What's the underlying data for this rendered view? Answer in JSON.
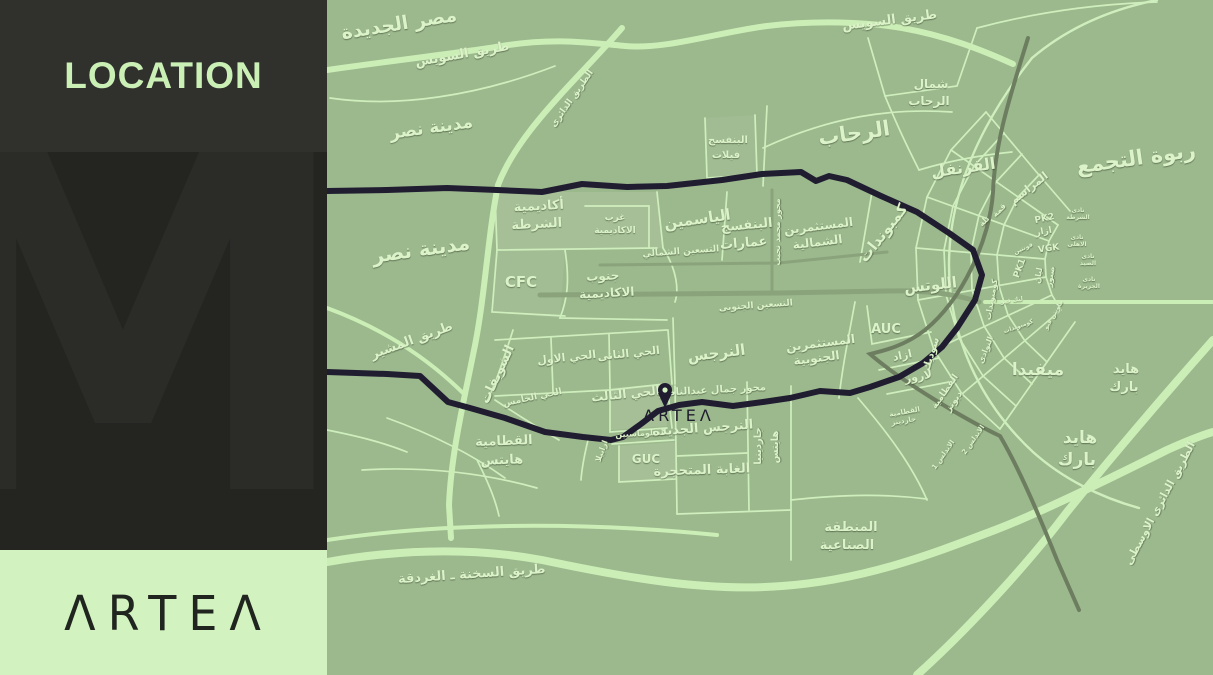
{
  "sidebar": {
    "title": "LOCATION",
    "watermark": "M",
    "logo_display": "ΛRTEΛ",
    "logo_brand": "ARTEA"
  },
  "colors": {
    "panel_dark": "#30302d",
    "panel_darker": "#242421",
    "accent_green": "#cbf0b6",
    "logo_panel_green": "#d2f2bf",
    "map_base": "#9cb88d",
    "road_light": "#cbeeb6",
    "road_gray": "#8aa37b",
    "road_olive": "#6d7e60",
    "route_navy": "#201d31",
    "label_light": "#dcf3c9"
  },
  "map": {
    "marker": {
      "brand": "ARTEA",
      "display": "ΛRTEΛ"
    },
    "labels": [
      {
        "t": "مصر الجديدة",
        "x": 73,
        "y": 30,
        "s": 19,
        "r": -9
      },
      {
        "t": "طريق السويس",
        "x": 136,
        "y": 58,
        "s": 13,
        "r": -10
      },
      {
        "t": "مدينة نصر",
        "x": 105,
        "y": 133,
        "s": 17,
        "r": -8
      },
      {
        "t": "مدينة نصر",
        "x": 95,
        "y": 256,
        "s": 20,
        "r": -8
      },
      {
        "t": "طريق المشير",
        "x": 86,
        "y": 344,
        "s": 13,
        "r": -20
      },
      {
        "t": "الطريق الدائرى",
        "x": 247,
        "y": 100,
        "s": 9,
        "r": -55
      },
      {
        "t": "طريق السويس",
        "x": 563,
        "y": 24,
        "s": 13,
        "r": -7
      },
      {
        "t": "شمال",
        "x": 604,
        "y": 88,
        "s": 12
      },
      {
        "t": "الرحاب",
        "x": 602,
        "y": 105,
        "s": 12
      },
      {
        "t": "الرحاب",
        "x": 528,
        "y": 140,
        "s": 21,
        "r": -8
      },
      {
        "t": "القرنفل",
        "x": 637,
        "y": 173,
        "s": 16,
        "r": -8
      },
      {
        "t": "ربوة التجمع",
        "x": 810,
        "y": 165,
        "s": 21,
        "r": -8
      },
      {
        "t": "البنفسج",
        "x": 401,
        "y": 143,
        "s": 10
      },
      {
        "t": "فيلات",
        "x": 399,
        "y": 158,
        "s": 10
      },
      {
        "t": "أكاديمية",
        "x": 212,
        "y": 210,
        "s": 13,
        "r": -3
      },
      {
        "t": "الشرطة",
        "x": 210,
        "y": 228,
        "s": 13,
        "r": -3
      },
      {
        "t": "غرب",
        "x": 288,
        "y": 220,
        "s": 9
      },
      {
        "t": "الاكاديمية",
        "x": 288,
        "y": 233,
        "s": 9
      },
      {
        "t": "الياسمين",
        "x": 371,
        "y": 224,
        "s": 15,
        "r": -8
      },
      {
        "t": "البنفسج",
        "x": 420,
        "y": 229,
        "s": 13,
        "r": -5
      },
      {
        "t": "عمارات",
        "x": 417,
        "y": 247,
        "s": 13,
        "r": -5
      },
      {
        "t": "المستثمرين",
        "x": 492,
        "y": 230,
        "s": 12,
        "r": -7
      },
      {
        "t": "الشمالية",
        "x": 491,
        "y": 246,
        "s": 12,
        "r": -7
      },
      {
        "t": "كمبوندات",
        "x": 560,
        "y": 236,
        "s": 15,
        "r": -52
      },
      {
        "t": "التسعين الشمالي",
        "x": 354,
        "y": 254,
        "s": 9,
        "r": -4
      },
      {
        "t": "محور محمد نجيب",
        "x": 453,
        "y": 232,
        "s": 8,
        "r": -90
      },
      {
        "t": "جنوب",
        "x": 276,
        "y": 280,
        "s": 12,
        "r": -3
      },
      {
        "t": "الاكاديمية",
        "x": 280,
        "y": 297,
        "s": 12,
        "r": -3
      },
      {
        "t": "CFC",
        "x": 194,
        "y": 287,
        "s": 15,
        "c": "lat"
      },
      {
        "t": "التسعين الجنوبى",
        "x": 429,
        "y": 308,
        "s": 9,
        "r": -4
      },
      {
        "t": "اللوتس",
        "x": 604,
        "y": 290,
        "s": 15,
        "r": -6
      },
      {
        "t": "المستثمرين",
        "x": 494,
        "y": 347,
        "s": 12,
        "r": -7
      },
      {
        "t": "الجنوبية",
        "x": 490,
        "y": 362,
        "s": 12,
        "r": -7
      },
      {
        "t": "AUC",
        "x": 559,
        "y": 333,
        "s": 13,
        "c": "lat"
      },
      {
        "t": "ازاد",
        "x": 576,
        "y": 359,
        "s": 11,
        "r": -12
      },
      {
        "t": "سوديك",
        "x": 607,
        "y": 355,
        "s": 10,
        "r": -72
      },
      {
        "t": "لاروز",
        "x": 592,
        "y": 380,
        "s": 11,
        "r": -10
      },
      {
        "t": "النوادى",
        "x": 661,
        "y": 351,
        "s": 8,
        "r": -68
      },
      {
        "t": "النرجس",
        "x": 390,
        "y": 358,
        "s": 15,
        "r": -7
      },
      {
        "t": "الحي الاول",
        "x": 240,
        "y": 361,
        "s": 11,
        "r": -6
      },
      {
        "t": "الحي الثانى",
        "x": 302,
        "y": 357,
        "s": 11,
        "r": -6
      },
      {
        "t": "الحي الثالث",
        "x": 299,
        "y": 398,
        "s": 12,
        "r": -6
      },
      {
        "t": "الحي الخامس",
        "x": 206,
        "y": 400,
        "s": 9,
        "r": -12
      },
      {
        "t": "الشويفات",
        "x": 174,
        "y": 376,
        "s": 13,
        "r": -65
      },
      {
        "t": "محور جمال عبدالناصر",
        "x": 386,
        "y": 393,
        "s": 10,
        "r": -3
      },
      {
        "t": "الدبلوماسيين",
        "x": 314,
        "y": 436,
        "s": 8,
        "r": -3
      },
      {
        "t": "ارابيلا",
        "x": 277,
        "y": 452,
        "s": 8,
        "r": -70
      },
      {
        "t": "GUC",
        "x": 319,
        "y": 463,
        "s": 12,
        "c": "lat"
      },
      {
        "t": "النرجس الجديدة",
        "x": 376,
        "y": 432,
        "s": 13,
        "r": -4
      },
      {
        "t": "الغابة المتحجرة",
        "x": 375,
        "y": 474,
        "s": 13,
        "r": -2
      },
      {
        "t": "جاردينيا",
        "x": 434,
        "y": 446,
        "s": 10,
        "r": -90
      },
      {
        "t": "هايتس",
        "x": 451,
        "y": 447,
        "s": 10,
        "r": -90
      },
      {
        "t": "القطامية",
        "x": 177,
        "y": 445,
        "s": 13,
        "r": -2
      },
      {
        "t": "هايتس",
        "x": 175,
        "y": 464,
        "s": 13,
        "r": -2
      },
      {
        "t": "المراسم",
        "x": 704,
        "y": 191,
        "s": 11,
        "r": -38
      },
      {
        "t": "قمة",
        "x": 674,
        "y": 212,
        "s": 8,
        "r": -45
      },
      {
        "t": "تلة",
        "x": 659,
        "y": 223,
        "s": 8,
        "r": -45
      },
      {
        "t": "PK2",
        "x": 718,
        "y": 221,
        "s": 9,
        "r": -12,
        "c": "lat"
      },
      {
        "t": "ازار",
        "x": 717,
        "y": 234,
        "s": 9,
        "r": -10
      },
      {
        "t": "فونتين",
        "x": 697,
        "y": 250,
        "s": 6,
        "r": -25
      },
      {
        "t": "VGK",
        "x": 722,
        "y": 251,
        "s": 9,
        "r": -8,
        "c": "lat"
      },
      {
        "t": "PK1",
        "x": 695,
        "y": 269,
        "s": 9,
        "r": -70,
        "c": "lat"
      },
      {
        "t": "ليان",
        "x": 714,
        "y": 276,
        "s": 8,
        "r": -80
      },
      {
        "t": "صبور",
        "x": 726,
        "y": 277,
        "s": 8,
        "r": -80
      },
      {
        "t": "نادى",
        "x": 751,
        "y": 212,
        "s": 6
      },
      {
        "t": "الشرطة",
        "x": 751,
        "y": 219,
        "s": 6
      },
      {
        "t": "نادى",
        "x": 750,
        "y": 239,
        "s": 6
      },
      {
        "t": "الاهلى",
        "x": 750,
        "y": 246,
        "s": 6
      },
      {
        "t": "نادى",
        "x": 761,
        "y": 258,
        "s": 6
      },
      {
        "t": "الصيد",
        "x": 761,
        "y": 265,
        "s": 6
      },
      {
        "t": "نادى",
        "x": 762,
        "y": 281,
        "s": 6
      },
      {
        "t": "الجزيرة",
        "x": 762,
        "y": 288,
        "s": 6
      },
      {
        "t": "ليك فيو",
        "x": 685,
        "y": 302,
        "s": 6,
        "r": -8
      },
      {
        "t": "كومبوندات",
        "x": 692,
        "y": 328,
        "s": 6,
        "r": -20
      },
      {
        "t": "كومبوندات",
        "x": 667,
        "y": 300,
        "s": 8,
        "r": -80
      },
      {
        "t": "ماونتن فيو",
        "x": 728,
        "y": 316,
        "s": 6,
        "r": -60
      },
      {
        "t": "ميفيدا",
        "x": 711,
        "y": 375,
        "s": 17
      },
      {
        "t": "هايد",
        "x": 799,
        "y": 373,
        "s": 13
      },
      {
        "t": "بارك",
        "x": 797,
        "y": 391,
        "s": 13
      },
      {
        "t": "هايد",
        "x": 753,
        "y": 443,
        "s": 17
      },
      {
        "t": "بارك",
        "x": 750,
        "y": 465,
        "s": 17
      },
      {
        "t": "القطامية",
        "x": 620,
        "y": 393,
        "s": 9,
        "r": -55
      },
      {
        "t": "ديونز",
        "x": 629,
        "y": 403,
        "s": 9,
        "r": -55
      },
      {
        "t": "القطامية",
        "x": 578,
        "y": 414,
        "s": 7,
        "r": -10
      },
      {
        "t": "جاردينز",
        "x": 577,
        "y": 423,
        "s": 7,
        "r": -10
      },
      {
        "t": "الاندلس 1",
        "x": 618,
        "y": 456,
        "s": 7,
        "r": -55
      },
      {
        "t": "الاندلس 2",
        "x": 648,
        "y": 441,
        "s": 7,
        "r": -55
      },
      {
        "t": "المنطقة",
        "x": 524,
        "y": 531,
        "s": 13
      },
      {
        "t": "الصناعية",
        "x": 520,
        "y": 549,
        "s": 13
      },
      {
        "t": "طريق السخنة ـ الغردقة",
        "x": 145,
        "y": 578,
        "s": 13,
        "r": -4
      },
      {
        "t": "الطريق الدائرى الاوسطى",
        "x": 836,
        "y": 505,
        "s": 11,
        "r": -62
      }
    ]
  }
}
